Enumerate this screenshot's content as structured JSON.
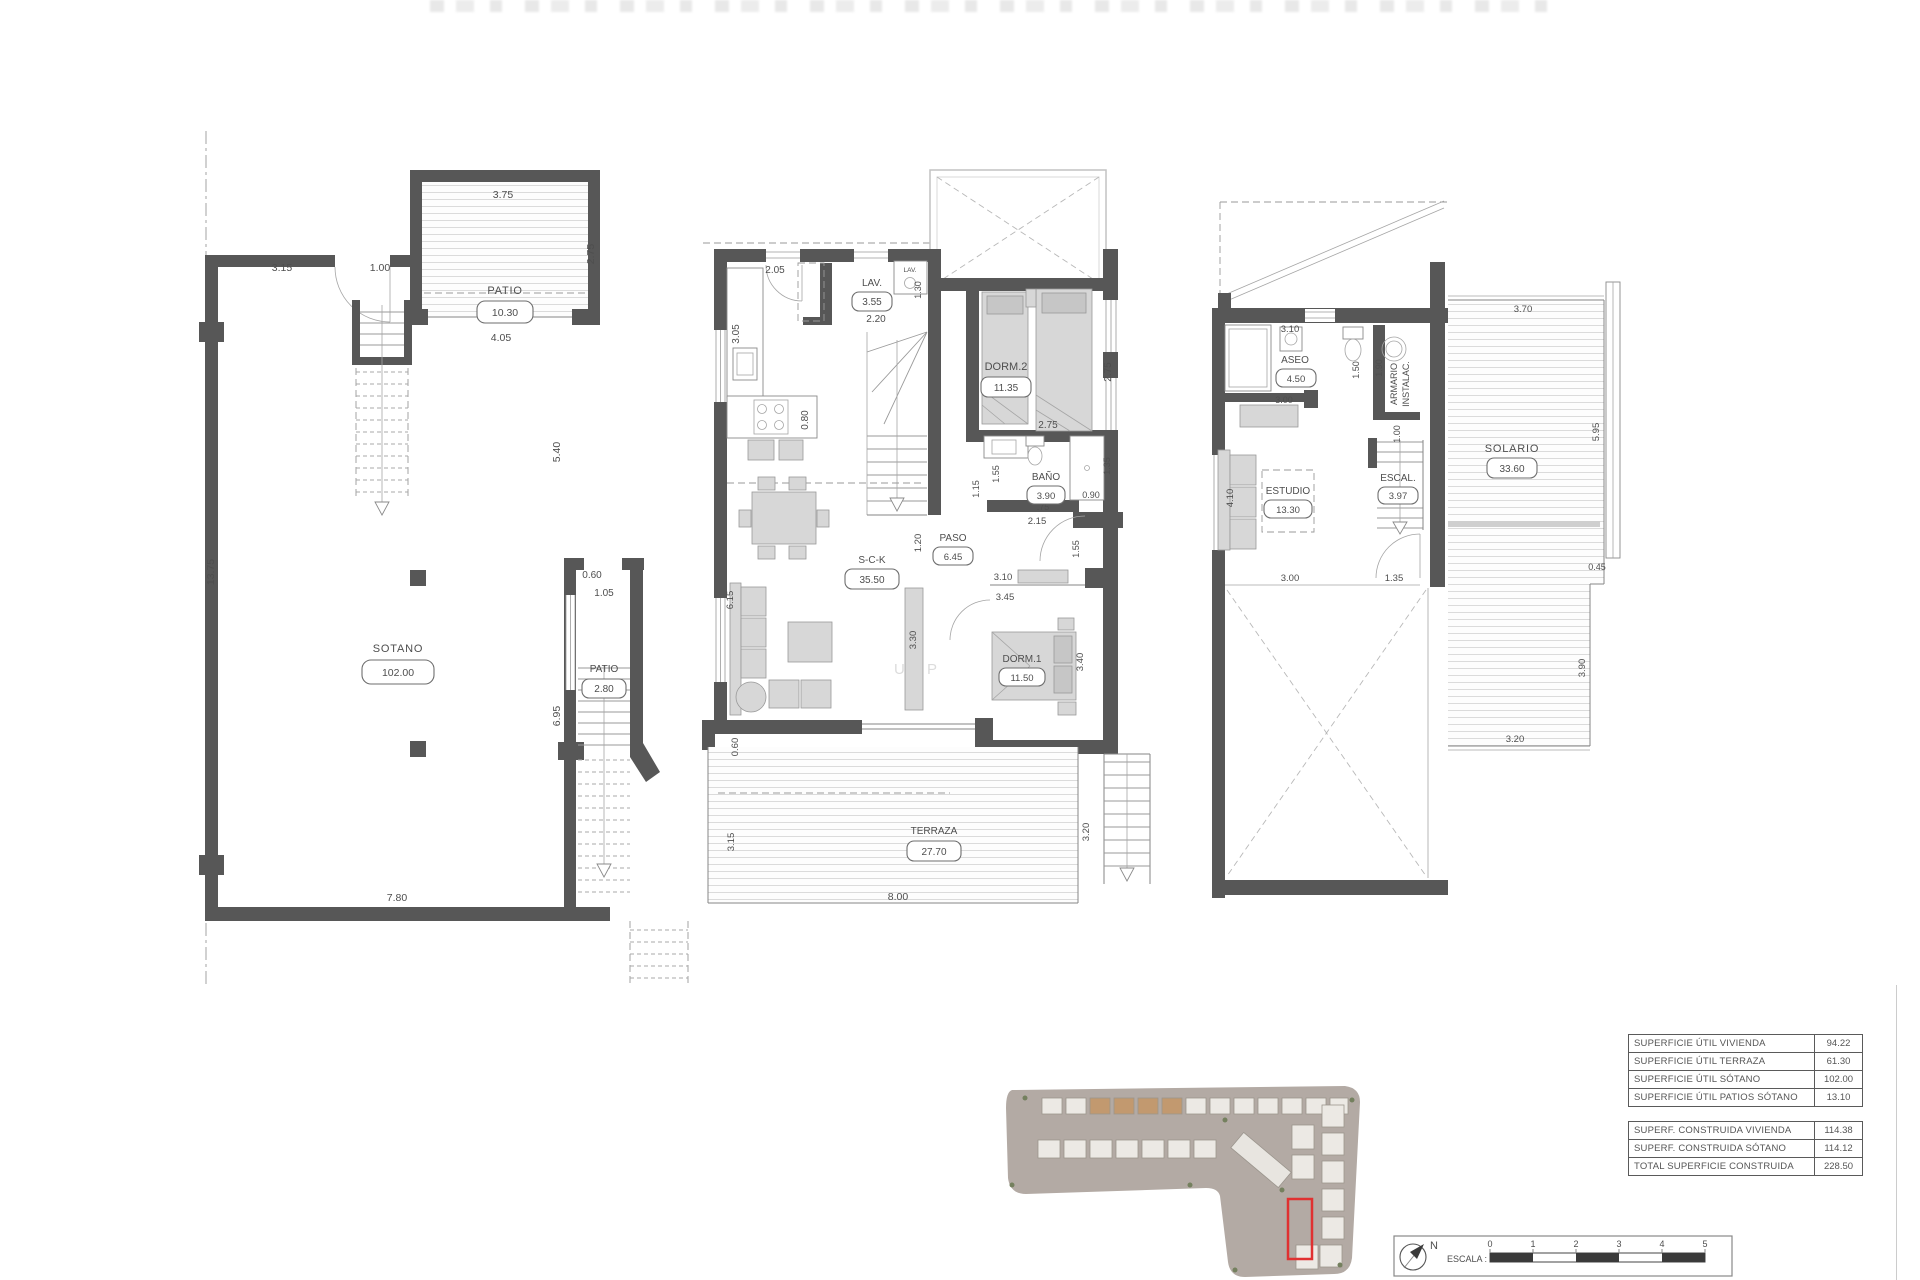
{
  "colors": {
    "wall": "#575757",
    "text": "#4e4e4e",
    "accent_red": "#e03131",
    "site_bg": "#b3aaa4"
  },
  "watermark": "U P",
  "plans": {
    "sotano": {
      "rooms": {
        "patio_top": {
          "label": "PATIO",
          "area": "10.30"
        },
        "main": {
          "label": "SOTANO",
          "area": "102.00"
        },
        "patio_side": {
          "label": "PATIO",
          "area": "2.80"
        }
      },
      "dims": {
        "patio_w": "3.75",
        "patio_h": "2.75",
        "top_left": "3.15",
        "top_door": "1.00",
        "patio_bottom": "4.05",
        "right_upper": "5.40",
        "left_h": "13.75",
        "strip_top": "0.60",
        "strip_top2": "1.05",
        "strip_h": "6.95",
        "bottom_w": "7.80"
      }
    },
    "planta_baja": {
      "rooms": {
        "lav": {
          "label": "LAV.",
          "area": "3.55"
        },
        "lav_appliance": "LAV.",
        "dorm2": {
          "label": "DORM.2",
          "area": "11.35"
        },
        "bano": {
          "label": "BAÑO",
          "area": "3.90"
        },
        "paso": {
          "label": "PASO",
          "area": "6.45"
        },
        "sck": {
          "label": "S-C-K",
          "area": "35.50"
        },
        "dorm1": {
          "label": "DORM.1",
          "area": "11.50"
        },
        "terraza": {
          "label": "TERRAZA",
          "area": "27.70"
        }
      },
      "dims": {
        "kitchen_top": "2.05",
        "kitchen_left": "3.05",
        "counter": "0.80",
        "lav_w": "2.20",
        "lav_side": "1.30",
        "dorm2_side": "2.75",
        "dorm2_w": "2.75",
        "bano_1": "1.15",
        "bano_2": "1.55",
        "bano_3": "1.35",
        "bano_4": "0.90",
        "bano_5": ".75",
        "paso_1": "2.15",
        "paso_2": "1.55",
        "paso_w": "1.20",
        "dorm1_1": "3.10",
        "dorm1_2": "3.45",
        "dorm1_side": "3.40",
        "living_left": "6.15",
        "living_right": "3.30",
        "step": "0.60",
        "terraza_left": "3.15",
        "terraza_w": "8.00",
        "stair_side": "3.20"
      }
    },
    "planta_alta": {
      "rooms": {
        "aseo": {
          "label": "ASEO",
          "area": "4.50"
        },
        "armario": {
          "label_line1": "ARMARIO",
          "label_line2": "INSTALAC.",
          "area": "1.00"
        },
        "estudio": {
          "label": "ESTUDIO",
          "area": "13.30"
        },
        "escal": {
          "label": "ESCAL.",
          "area": "3.97"
        },
        "solario": {
          "label": "SOLARIO",
          "area": "33.60"
        }
      },
      "dims": {
        "aseo_top": "3.10",
        "aseo_1": "1.50",
        "aseo_2": "1.90",
        "armario_w": "1.00",
        "desk": "3.00",
        "estudio_left": "4.10",
        "void_w": "3.00",
        "void_w2": "1.35",
        "solario_top": "3.70",
        "solario_right": "5.95",
        "solario_step": "0.45",
        "solario_right2": "3.90",
        "solario_bottom": "3.20"
      }
    }
  },
  "tables": {
    "util": [
      {
        "label": "SUPERFICIE ÚTIL VIVIENDA",
        "value": "94.22"
      },
      {
        "label": "SUPERFICIE ÚTIL TERRAZA",
        "value": "61.30"
      },
      {
        "label": "SUPERFICIE ÚTIL SÓTANO",
        "value": "102.00"
      },
      {
        "label": "SUPERFICIE ÚTIL PATIOS SÓTANO",
        "value": "13.10"
      }
    ],
    "construida": [
      {
        "label": "SUPERF. CONSTRUIDA VIVIENDA",
        "value": "114.38"
      },
      {
        "label": "SUPERF. CONSTRUIDA SÓTANO",
        "value": "114.12"
      },
      {
        "label": "TOTAL SUPERFICIE CONSTRUIDA",
        "value": "228.50"
      }
    ]
  },
  "scale_bar": {
    "north": "N",
    "label": "ESCALA :",
    "ticks": [
      "0",
      "1",
      "2",
      "3",
      "4",
      "5"
    ]
  }
}
